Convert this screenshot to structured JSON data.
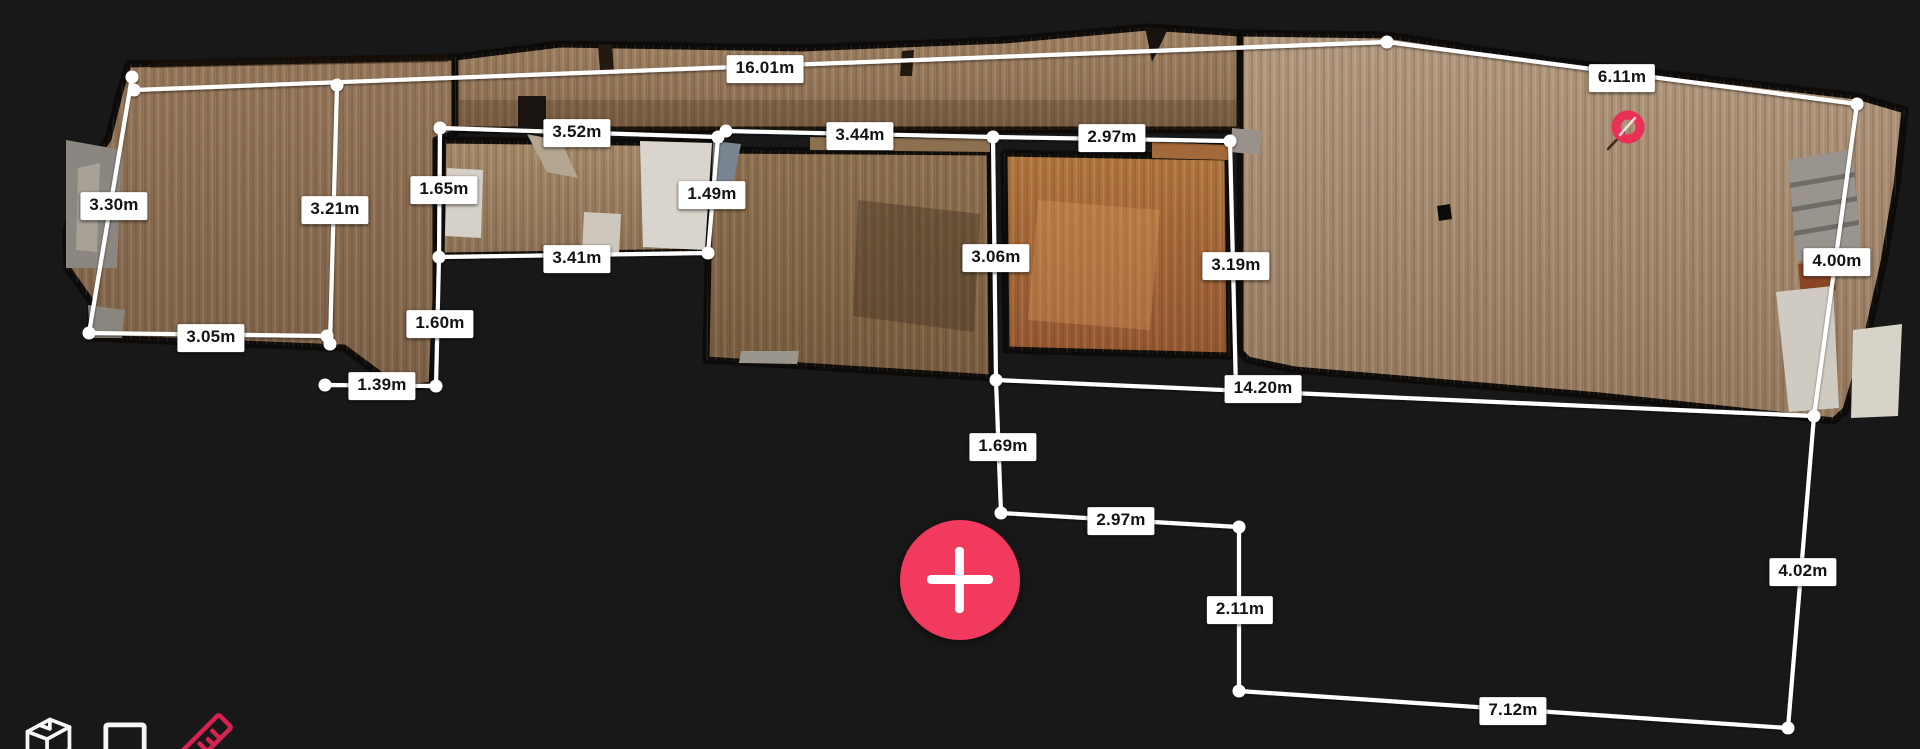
{
  "canvas": {
    "width": 1920,
    "height": 749,
    "background": "#181818"
  },
  "colors": {
    "accent_pink": "#f13a5e",
    "ruler_pink": "#d6224e",
    "marker_pink": "#e93056",
    "line_white": "#ffffff",
    "label_bg": "#ffffff",
    "label_text": "#131313",
    "wall_black": "#0d0b09",
    "icon_white": "#f5f5f5"
  },
  "measurements": [
    {
      "label": "16.01m",
      "x1": 134,
      "y1": 90,
      "x2": 1387,
      "y2": 42,
      "lx": 765,
      "ly": 69
    },
    {
      "label": "6.11m",
      "x1": 1387,
      "y1": 42,
      "x2": 1857,
      "y2": 104,
      "lx": 1622,
      "ly": 78
    },
    {
      "label": "4.00m",
      "x1": 1857,
      "y1": 104,
      "x2": 1814,
      "y2": 416,
      "lx": 1837,
      "ly": 262
    },
    {
      "label": "4.02m",
      "x1": 1814,
      "y1": 416,
      "x2": 1788,
      "y2": 728,
      "lx": 1803,
      "ly": 572
    },
    {
      "label": "7.12m",
      "x1": 1788,
      "y1": 728,
      "x2": 1239,
      "y2": 691,
      "lx": 1513,
      "ly": 711
    },
    {
      "label": "2.11m",
      "x1": 1239,
      "y1": 691,
      "x2": 1239,
      "y2": 527,
      "lx": 1240,
      "ly": 610
    },
    {
      "label": "2.97m",
      "x1": 1239,
      "y1": 527,
      "x2": 1001,
      "y2": 513,
      "lx": 1121,
      "ly": 521
    },
    {
      "label": "1.69m",
      "x1": 1001,
      "y1": 513,
      "x2": 996,
      "y2": 380,
      "lx": 1003,
      "ly": 447
    },
    {
      "label": "14.20m",
      "x1": 996,
      "y1": 380,
      "x2": 1814,
      "y2": 416,
      "lx": 1263,
      "ly": 389
    },
    {
      "label": "3.30m",
      "x1": 132,
      "y1": 77,
      "x2": 89,
      "y2": 333,
      "lx": 114,
      "ly": 206
    },
    {
      "label": "3.05m",
      "x1": 89,
      "y1": 333,
      "x2": 327,
      "y2": 336,
      "lx": 211,
      "ly": 338
    },
    {
      "label": "3.21m",
      "x1": 337,
      "y1": 85,
      "x2": 330,
      "y2": 344,
      "lx": 335,
      "ly": 210
    },
    {
      "label": "1.39m",
      "x1": 325,
      "y1": 385,
      "x2": 436,
      "y2": 386,
      "lx": 382,
      "ly": 386
    },
    {
      "label": "1.65m",
      "x1": 440,
      "y1": 128,
      "x2": 439,
      "y2": 257,
      "lx": 444,
      "ly": 190
    },
    {
      "label": "1.60m",
      "x1": 439,
      "y1": 257,
      "x2": 436,
      "y2": 386,
      "lx": 440,
      "ly": 324
    },
    {
      "label": "3.52m",
      "x1": 440,
      "y1": 128,
      "x2": 718,
      "y2": 137,
      "lx": 577,
      "ly": 133
    },
    {
      "label": "1.49m",
      "x1": 718,
      "y1": 137,
      "x2": 708,
      "y2": 253,
      "lx": 712,
      "ly": 195
    },
    {
      "label": "3.41m",
      "x1": 439,
      "y1": 257,
      "x2": 708,
      "y2": 253,
      "lx": 577,
      "ly": 259
    },
    {
      "label": "3.44m",
      "x1": 726,
      "y1": 131,
      "x2": 993,
      "y2": 137,
      "lx": 860,
      "ly": 136
    },
    {
      "label": "2.97m",
      "x1": 993,
      "y1": 137,
      "x2": 1230,
      "y2": 141,
      "lx": 1112,
      "ly": 138
    },
    {
      "label": "3.06m",
      "x1": 993,
      "y1": 137,
      "x2": 996,
      "y2": 380,
      "lx": 996,
      "ly": 258
    },
    {
      "label": "3.19m",
      "x1": 1230,
      "y1": 141,
      "x2": 1236,
      "y2": 390,
      "lx": 1236,
      "ly": 266
    }
  ],
  "vertices": [
    [
      132,
      77
    ],
    [
      134,
      90
    ],
    [
      337,
      85
    ],
    [
      1387,
      42
    ],
    [
      1857,
      104
    ],
    [
      1814,
      416
    ],
    [
      1788,
      728
    ],
    [
      1239,
      691
    ],
    [
      1239,
      527
    ],
    [
      1001,
      513
    ],
    [
      996,
      380
    ],
    [
      89,
      333
    ],
    [
      327,
      336
    ],
    [
      330,
      344
    ],
    [
      325,
      385
    ],
    [
      436,
      386
    ],
    [
      440,
      128
    ],
    [
      439,
      257
    ],
    [
      718,
      137
    ],
    [
      726,
      131
    ],
    [
      708,
      253
    ],
    [
      993,
      137
    ],
    [
      1230,
      141
    ]
  ],
  "marker": {
    "x": 1628,
    "y": 127
  },
  "fab": {
    "x": 960,
    "y": 580,
    "radius": 60
  },
  "toolbar": {
    "items": [
      {
        "name": "dollhouse-view",
        "active": false
      },
      {
        "name": "floorplan-view",
        "active": false
      },
      {
        "name": "measure-tool",
        "active": true
      }
    ]
  },
  "scene": {
    "rooms": [
      {
        "name": "left-room-and-corridor",
        "c1": "#97795c",
        "c2": "#7d6148",
        "points": "128,64 455,57 455,133 436,140 436,300 432,385 399,389 344,348 90,338 91,302 67,268 66,231 79,180 108,139 120,91"
      },
      {
        "name": "top-hallway",
        "c1": "#a28465",
        "c2": "#8a6c50",
        "points": "455,57 560,44 800,48 1005,40 1148,27 1240,33 1240,130 455,130"
      },
      {
        "name": "right-room",
        "c1": "#b49b81",
        "c2": "#95795e",
        "points": "1240,33 1387,35 1550,60 1857,96 1905,110 1897,185 1884,262 1866,342 1846,410 1834,421 1600,396 1295,370 1248,360 1240,352"
      },
      {
        "name": "room-a",
        "c1": "#a78c6b",
        "c2": "#8e7356",
        "points": "443,140 716,143 707,252 441,256"
      },
      {
        "name": "room-b",
        "c1": "#8f7251",
        "c2": "#775c3f",
        "points": "710,150 990,152 992,378 706,360"
      },
      {
        "name": "room-c",
        "c1": "#b2773f",
        "c2": "#955831",
        "points": "1004,153 1228,157 1230,356 1006,350"
      }
    ],
    "details": [
      {
        "name": "left-wall-fragment",
        "points": "66,140 122,150 117,268 66,268",
        "fill": "#8b8680"
      },
      {
        "name": "left-wall-highlight",
        "points": "78,168 100,163 97,252 76,250",
        "fill": "#a7a196"
      },
      {
        "name": "left-corner-gray",
        "points": "88,305 125,310 122,338 90,338",
        "fill": "#8a857d"
      },
      {
        "name": "band-top-dark-strip",
        "points": "150,60 448,54 448,62 150,68",
        "fill": "rgba(30,18,8,0.5)"
      },
      {
        "name": "band-bottom-shade",
        "points": "455,100 1240,100 1240,130 455,130",
        "fill": "rgba(60,40,20,0.22)"
      },
      {
        "name": "band-dark-door",
        "points": "518,96 546,96 546,130 518,130",
        "fill": "#19140f"
      },
      {
        "name": "band-notch-1",
        "points": "598,45 612,44 614,72 600,72",
        "fill": "#221910"
      },
      {
        "name": "band-notch-2",
        "points": "902,51 914,50 912,76 900,76",
        "fill": "#221910"
      },
      {
        "name": "peak-notch",
        "points": "1145,27 1168,29 1152,62",
        "fill": "#171310"
      },
      {
        "name": "room-a-white-floor",
        "points": "640,141 712,143 705,250 643,247",
        "fill": "#d9d5cd"
      },
      {
        "name": "room-a-white-rect",
        "points": "447,168 483,170 481,238 445,236",
        "fill": "#d5d0c8"
      },
      {
        "name": "room-a-white-low",
        "points": "584,212 621,214 619,254 582,252",
        "fill": "#cdc7bd"
      },
      {
        "name": "room-a-plank-object",
        "points": "527,134 561,141 578,178 547,172",
        "fill": "#b4a690"
      },
      {
        "name": "slate-shard",
        "points": "713,141 741,144 733,184 712,181",
        "fill": "#7b8591"
      },
      {
        "name": "room-b-bridge",
        "points": "810,137 990,139 990,152 810,150",
        "fill": "#8d7050"
      },
      {
        "name": "room-b-smudge",
        "points": "858,200 980,214 974,332 853,316",
        "fill": "rgba(66,48,30,0.4)"
      },
      {
        "name": "room-b-threshold",
        "points": "741,351 799,351 797,364 739,363",
        "fill": "#9a958d"
      },
      {
        "name": "room-c-bridge",
        "points": "1152,142 1228,145 1228,160 1152,158",
        "fill": "#a4693a"
      },
      {
        "name": "room-c-light-patch",
        "points": "1038,200 1160,210 1150,330 1028,320",
        "fill": "rgba(216,156,94,0.35)"
      },
      {
        "name": "right-room-gray-corner",
        "points": "1232,128 1262,131 1259,155 1231,152",
        "fill": "#98928a"
      },
      {
        "name": "right-room-hole",
        "points": "1437,206 1450,204 1452,219 1439,221",
        "fill": "#0d0b09"
      },
      {
        "name": "stairs",
        "points": "1788,160 1852,149 1861,253 1797,261",
        "fill": "#99948e"
      },
      {
        "name": "stair-step-1",
        "points": "1790,183 1855,172 1855,177 1790,188",
        "fill": "#6f6b66"
      },
      {
        "name": "stair-step-2",
        "points": "1792,207 1857,196 1857,201 1792,212",
        "fill": "#6f6b66"
      },
      {
        "name": "stair-step-3",
        "points": "1794,231 1859,220 1859,225 1794,236",
        "fill": "#6f6b66"
      },
      {
        "name": "fixture-orange",
        "points": "1798,264 1833,259 1836,290 1801,294",
        "fill": "#8a4527"
      },
      {
        "name": "fixture-white-1",
        "points": "1776,292 1833,286 1839,408 1789,412",
        "fill": "#cfcbc2"
      },
      {
        "name": "fixture-white-2",
        "points": "1853,330 1902,324 1898,416 1851,418",
        "fill": "#d7d3c9"
      }
    ]
  }
}
